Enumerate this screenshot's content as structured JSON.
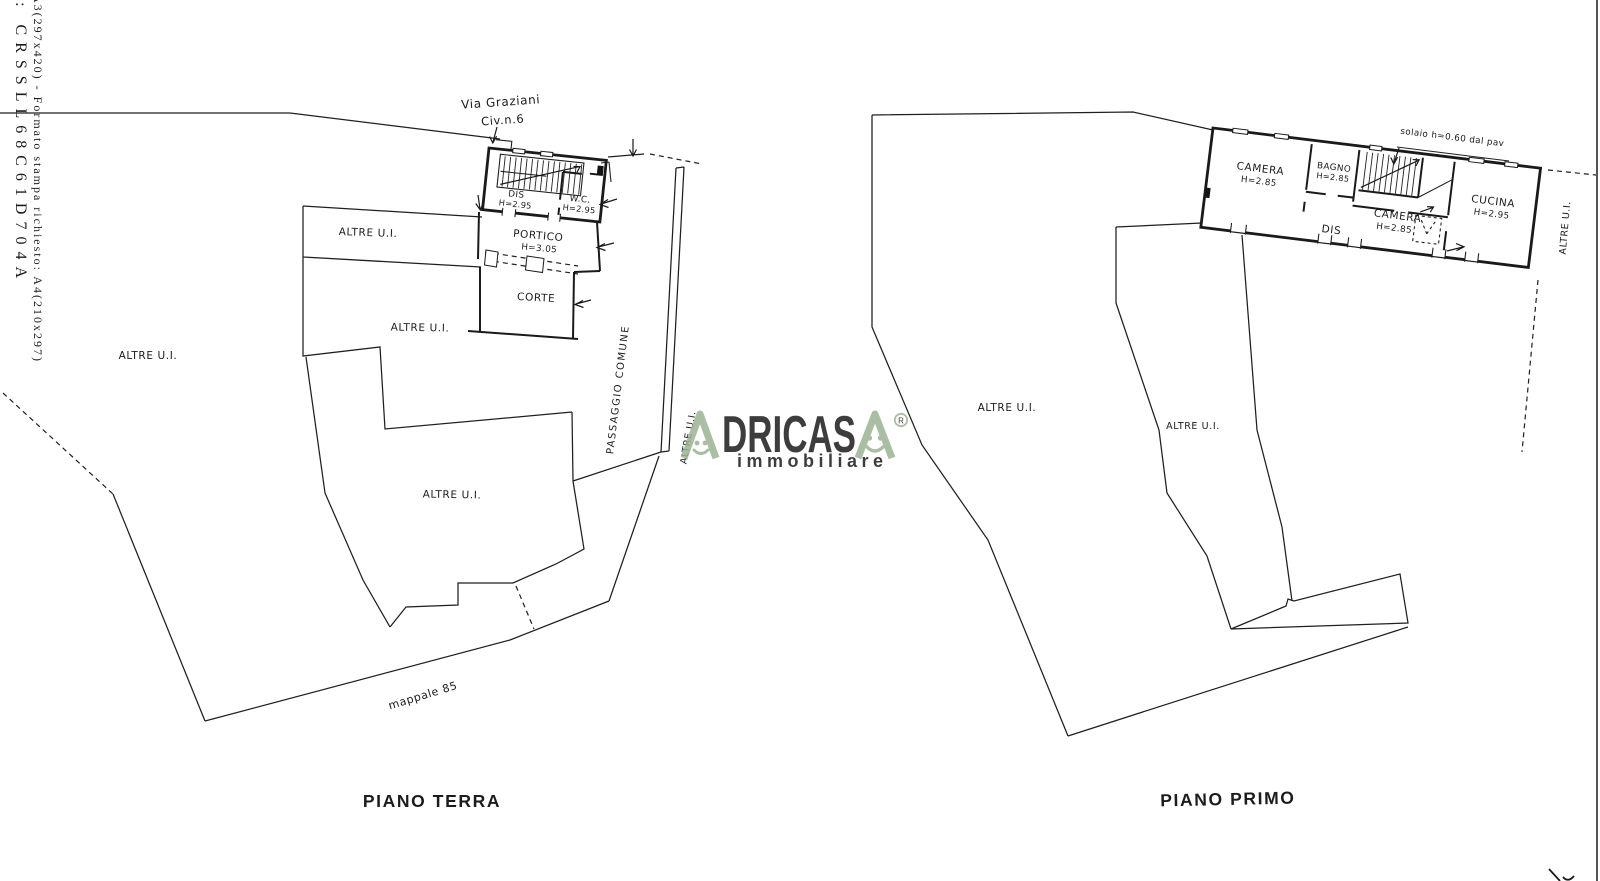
{
  "document": {
    "margin_line1": "e: CRSSLL68C61D704A",
    "margin_line2": "A3(297x420) - Formato stampa richiesto: A4(210x297)",
    "ink_color": "#1c1c1c"
  },
  "watermark": {
    "brand": "ADRICASA",
    "brand_middle": "DRICAS",
    "subtitle": "immobiliare",
    "registered": "R",
    "color": "#9cb394"
  },
  "terra": {
    "title": "PIANO TERRA",
    "via": "Via Graziani",
    "civ": "Civ.n.6",
    "dis": "DIS",
    "dis_h": "H=2.95",
    "wc": "W.C.",
    "wc_h": "H=2.95",
    "portico": "PORTICO",
    "portico_h": "H=3.05",
    "corte": "CORTE",
    "altre1": "ALTRE U.I.",
    "altre2": "ALTRE U.I.",
    "altre3": "ALTRE U.I.",
    "altre4": "ALTRE U.I.",
    "altre5": "ALTRE U.I.",
    "passaggio": "PASSAGGIO COMUNE",
    "mappale": "mappale 85"
  },
  "primo": {
    "title": "PIANO PRIMO",
    "camera1": "CAMERA",
    "camera1_h": "H=2.85",
    "bagno": "BAGNO",
    "bagno_h": "H=2.85",
    "camera2": "CAMERA",
    "camera2_h": "H=2.85",
    "cucina": "CUCINA",
    "cucina_h": "H=2.95",
    "dis": "DIS",
    "solaio": "solaio h=0.60 dal pav",
    "altre1": "ALTRE U.I.",
    "altre2": "ALTRE U.I.",
    "altre3": "ALTRE U.I."
  }
}
